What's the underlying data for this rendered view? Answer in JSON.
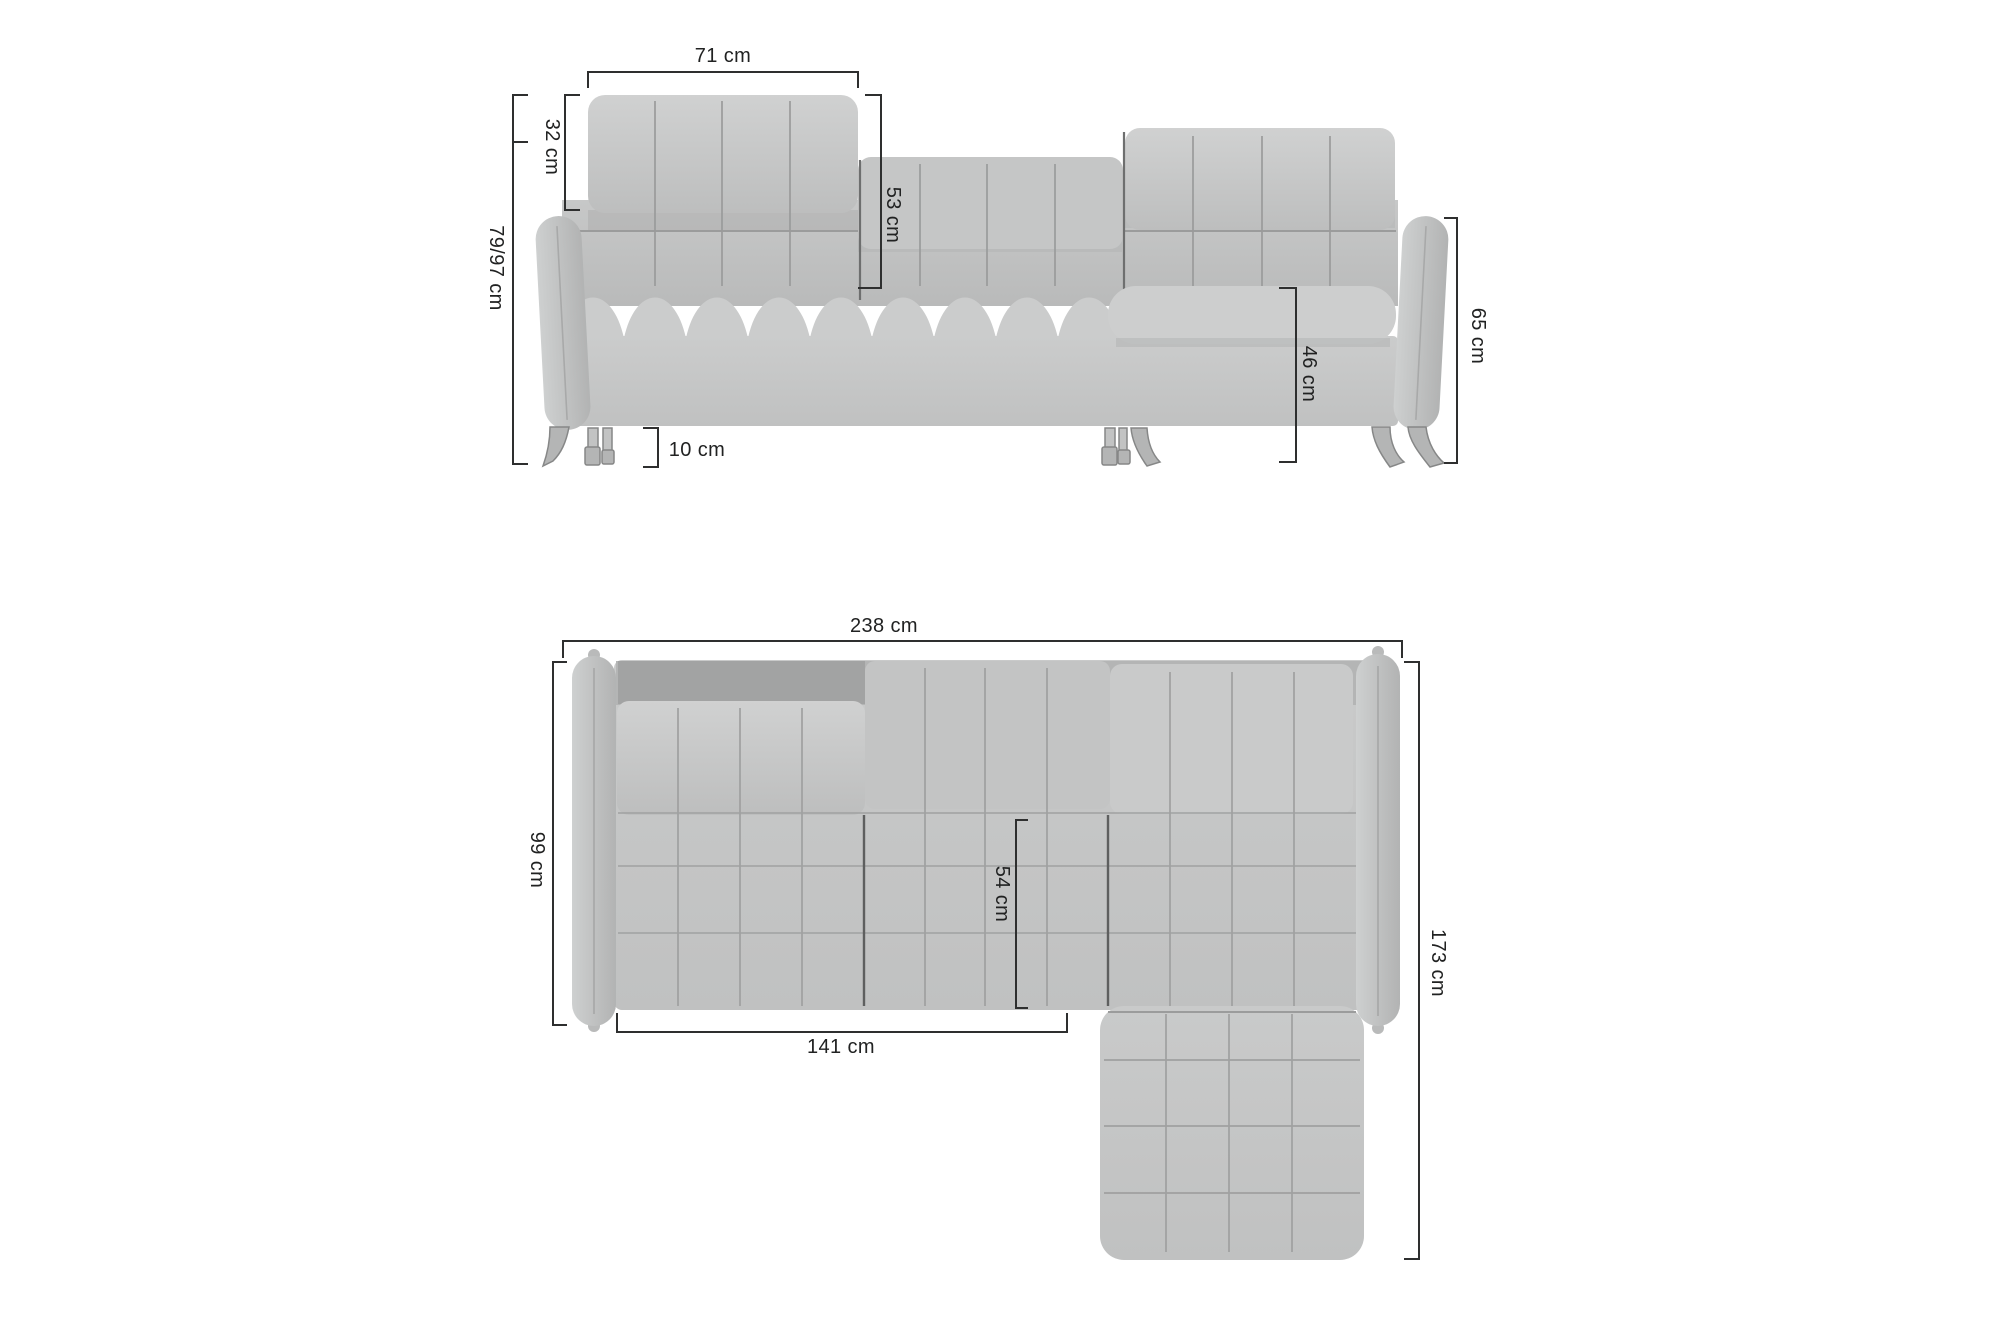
{
  "diagram": {
    "subject": "corner sofa dimension drawing",
    "unit": "cm",
    "background_color": "#ffffff"
  },
  "views": {
    "front": {
      "name": "front-view",
      "dimensions": [
        {
          "id": "headrest-width",
          "label": "71 cm",
          "orientation": "horizontal"
        },
        {
          "id": "headrest-height",
          "label": "32 cm",
          "orientation": "vertical"
        },
        {
          "id": "total-height",
          "label": "79/97 cm",
          "orientation": "vertical"
        },
        {
          "id": "backrest-height",
          "label": "53 cm",
          "orientation": "vertical"
        },
        {
          "id": "leg-height",
          "label": "10 cm",
          "orientation": "horizontal"
        },
        {
          "id": "seat-height",
          "label": "46 cm",
          "orientation": "vertical"
        },
        {
          "id": "armrest-height",
          "label": "65 cm",
          "orientation": "vertical"
        }
      ]
    },
    "top": {
      "name": "top-view",
      "dimensions": [
        {
          "id": "total-width",
          "label": "238 cm",
          "orientation": "horizontal"
        },
        {
          "id": "total-depth",
          "label": "99 cm",
          "orientation": "vertical"
        },
        {
          "id": "seat-depth",
          "label": "54 cm",
          "orientation": "vertical"
        },
        {
          "id": "seat-width",
          "label": "141 cm",
          "orientation": "horizontal"
        },
        {
          "id": "chaise-depth",
          "label": "173 cm",
          "orientation": "vertical"
        }
      ]
    }
  },
  "colors": {
    "background": "#ffffff",
    "sofa_fill": "#c6c7c7",
    "sofa_highlight": "#d0d1d1",
    "sofa_shadow": "#a7a8a8",
    "seam": "#9a9b9b",
    "dark_seam": "#646565",
    "leg_fill": "#b4b5b5",
    "dimension_line": "#2e2f2f",
    "text": "#212222"
  }
}
